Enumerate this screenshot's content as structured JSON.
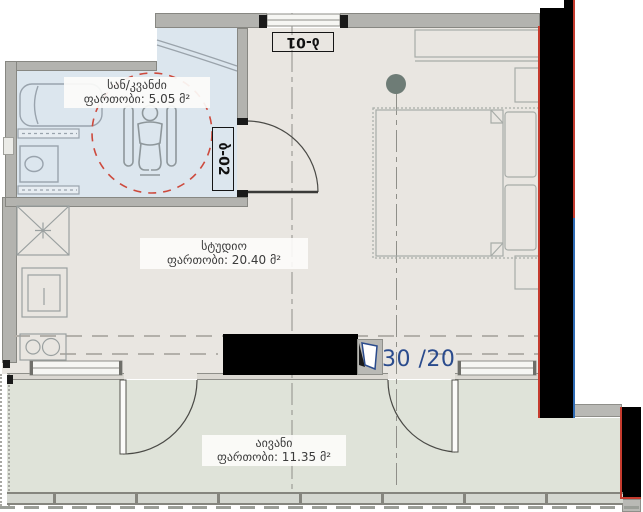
{
  "unit": {
    "number": "30 /20"
  },
  "rooms": {
    "bathroom": {
      "name": "სან/კვანძი",
      "area": "ფართობი: 5.05 მ²"
    },
    "studio": {
      "name": "სტუდიო",
      "area": "ფართობი: 20.40 მ²"
    },
    "balcony": {
      "name": "აივანი",
      "area": "ფართობი: 11.35 მ²"
    }
  },
  "tags": {
    "top_window": "ბ-01",
    "bathroom_door": "ბ-02"
  },
  "colors": {
    "bathroom_fill": "#dce6ee",
    "studio_fill": "#e9e6e1",
    "balcony_fill": "#dfe3d9",
    "wall_gray": "#b3b3af",
    "structure_black": "#000000",
    "line_red": "#c53b2e",
    "line_blue": "#2e6bb5",
    "unit_number_blue": "#2a4b8d",
    "column_marker_green": "#6e7c76",
    "accessibility_dash_red": "#cd4a3d"
  }
}
